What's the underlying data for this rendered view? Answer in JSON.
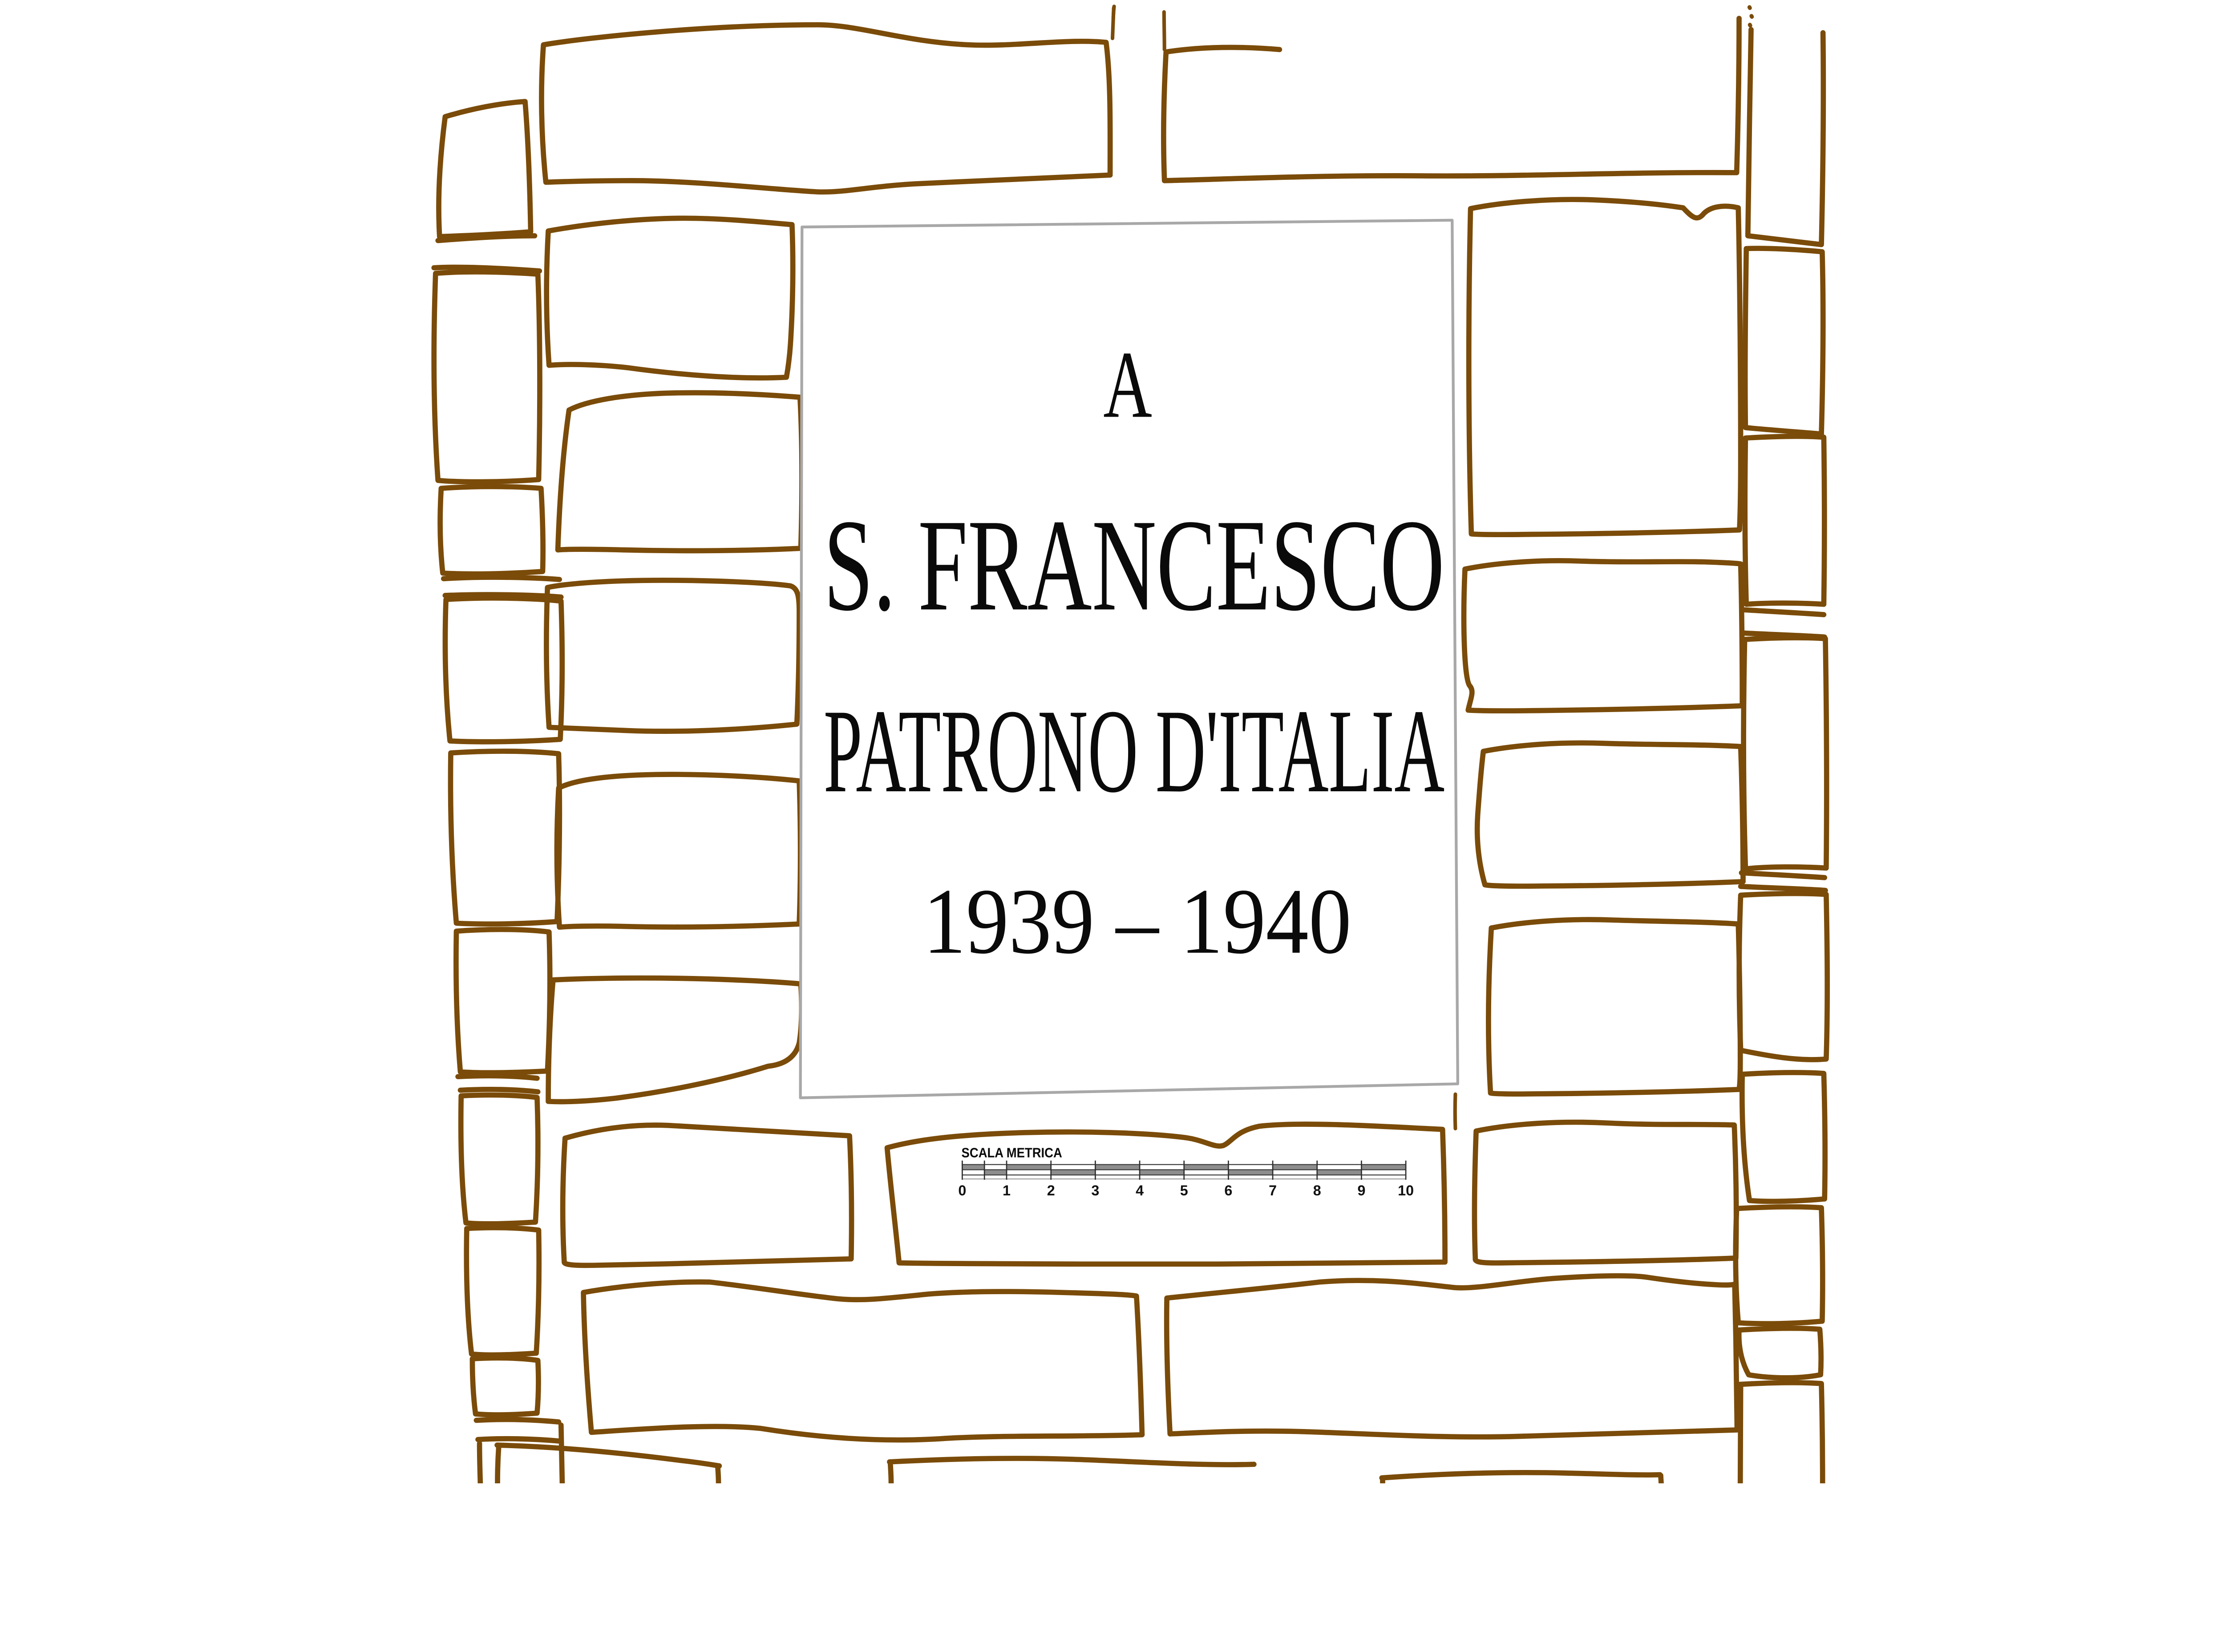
{
  "canvas": {
    "background": "#ffffff"
  },
  "colors": {
    "stone_outline": "#7a4b09",
    "plaque_border": "#a8a8a8",
    "ink": "#0a0a0a",
    "scale_segment": "#8d8d8d"
  },
  "plaque": {
    "line1": "A",
    "line2": "S. FRANCESCO",
    "line3": "PATRONO D'ITALIA",
    "line4": "1939 – 1940"
  },
  "scale": {
    "title": "SCALA METRICA",
    "tick_labels": [
      "0",
      "1",
      "2",
      "3",
      "4",
      "5",
      "6",
      "7",
      "8",
      "9",
      "10"
    ]
  }
}
